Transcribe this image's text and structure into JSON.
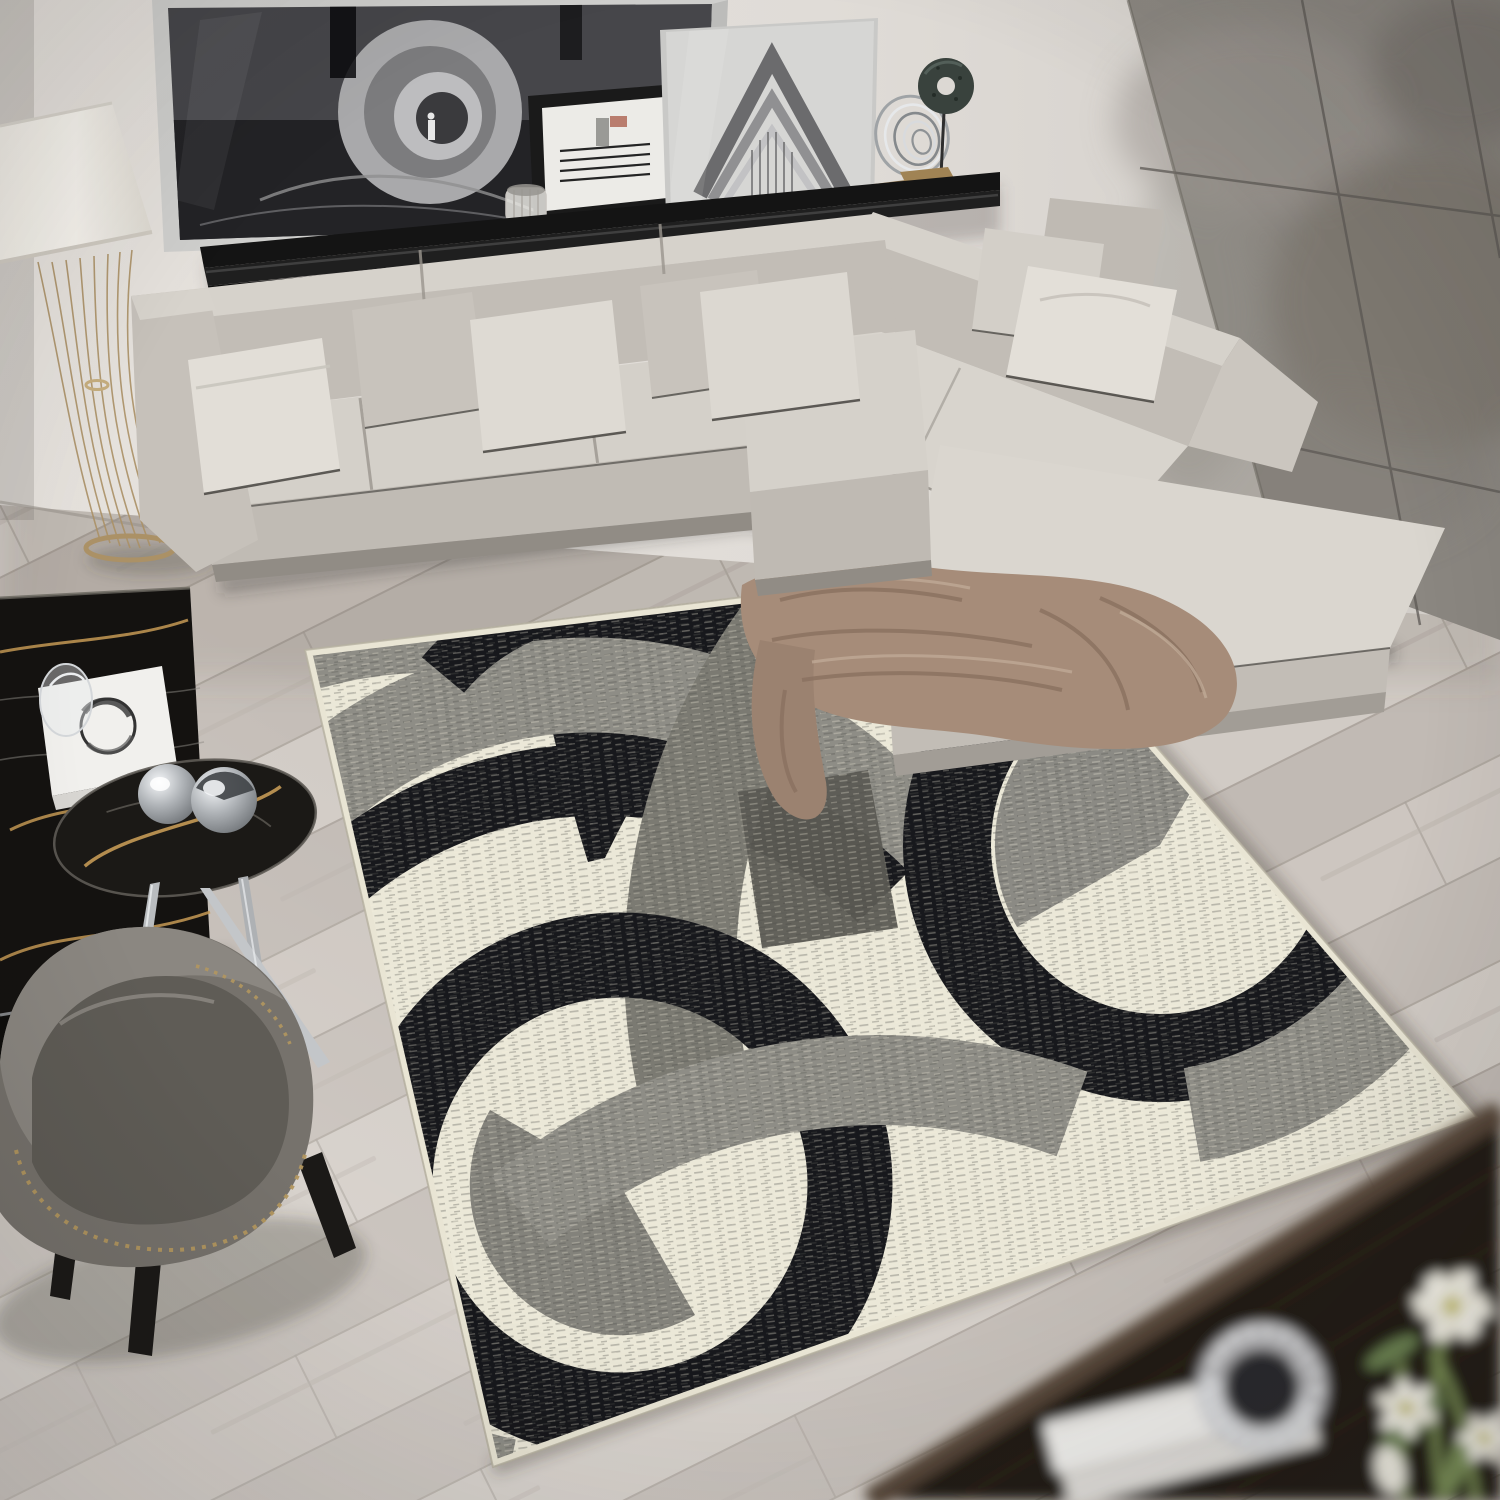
{
  "meta": {
    "title": "Modern living room scene: gray L-shaped sectional sofa, black shelf with monochrome artwork, floor lamp, marble tables, gray armchair and a cream area rug with overlapping black and gray circle pattern on diagonal wood flooring",
    "type": "product-lifestyle-photograph",
    "text_on_screen": "none"
  },
  "colors": {
    "wall": "#e2ded9",
    "wall-dark": "#d2cdc8",
    "concrete": "#8b8781",
    "concrete-seam": "#5c5954",
    "floor": "#c9c2bc",
    "floor-seam": "#a8a099",
    "sofa-top": "#d6d2cb",
    "sofa-front": "#c2bdb6",
    "sofa-body": "#c6c1ba",
    "sofa-plinth": "#918c85",
    "pillow-light": "#e2ded7",
    "pillow-mid": "#c8c3bc",
    "piping": "#3c3a36",
    "blanket": "#a68c79",
    "blanket-fold": "#8a7160",
    "rug-cream": "#ebe8d8",
    "rug-black": "#17181c",
    "rug-gray": "#8e8d86",
    "rug-midgray": "#7b7a72",
    "rug-darkgray": "#5c5b54",
    "rug-binding": "#e9e5d4",
    "shelf-black": "#141414",
    "frame-silver": "#cfcfcd",
    "art-dark": "#46464a",
    "lamp-shade": "#f4f1ea",
    "lamp-gold": "#ab9166",
    "marble-black": "#141210",
    "marble-vein": "#c59a55",
    "chrome": "#c6c9cc",
    "chair-fabric": "#76726c",
    "chair-seat": "#5f5c56",
    "chair-leg": "#1b1917",
    "nailhead": "#b3975f",
    "wood-dark": "#241c15",
    "wood-edge": "#57483a",
    "book-white": "#f1f0ed",
    "flower-white": "#f6f4ea",
    "flower-green": "#7d9257",
    "stone-green": "#39423d"
  },
  "scene": {
    "objects": [
      {
        "name": "back-wall",
        "label": "light greige wall"
      },
      {
        "name": "concrete-wall",
        "label": "gray concrete panel accent wall"
      },
      {
        "name": "wood-floor",
        "label": "diagonal light gray wood plank floor"
      },
      {
        "name": "wall-shelf",
        "label": "black gloss floating shelf"
      },
      {
        "name": "artwork-tunnel",
        "label": "large black and white tunnel photograph"
      },
      {
        "name": "artwork-lines",
        "label": "small black framed line art"
      },
      {
        "name": "artwork-opera",
        "label": "glass framed architectural photo"
      },
      {
        "name": "sculpture-rings",
        "label": "silver spiral ring sculpture"
      },
      {
        "name": "sculpture-disc",
        "label": "green stone disc sculpture"
      },
      {
        "name": "floor-lamp",
        "label": "floor lamp with white shade and gold wire base"
      },
      {
        "name": "sectional-sofa",
        "label": "light gray L-shaped sectional sofa with pillows"
      },
      {
        "name": "throw-blanket",
        "label": "taupe throw blanket on ottoman"
      },
      {
        "name": "area-rug",
        "label": "cream rug with black and gray overlapping circles"
      },
      {
        "name": "coffee-table",
        "label": "black marble coffee table with gold veining"
      },
      {
        "name": "side-table",
        "label": "oval dark marble side table with chrome legs"
      },
      {
        "name": "decor-book",
        "label": "white art book"
      },
      {
        "name": "decor-spheres",
        "label": "chrome sphere ornaments"
      },
      {
        "name": "armchair",
        "label": "gray armchair with nailhead trim"
      },
      {
        "name": "foreground-table",
        "label": "dark wood table in blurred foreground"
      },
      {
        "name": "foreground-books",
        "label": "white books"
      },
      {
        "name": "foreground-votive",
        "label": "crystal votive holder"
      },
      {
        "name": "foreground-flowers",
        "label": "white lilies with green stems"
      }
    ]
  }
}
